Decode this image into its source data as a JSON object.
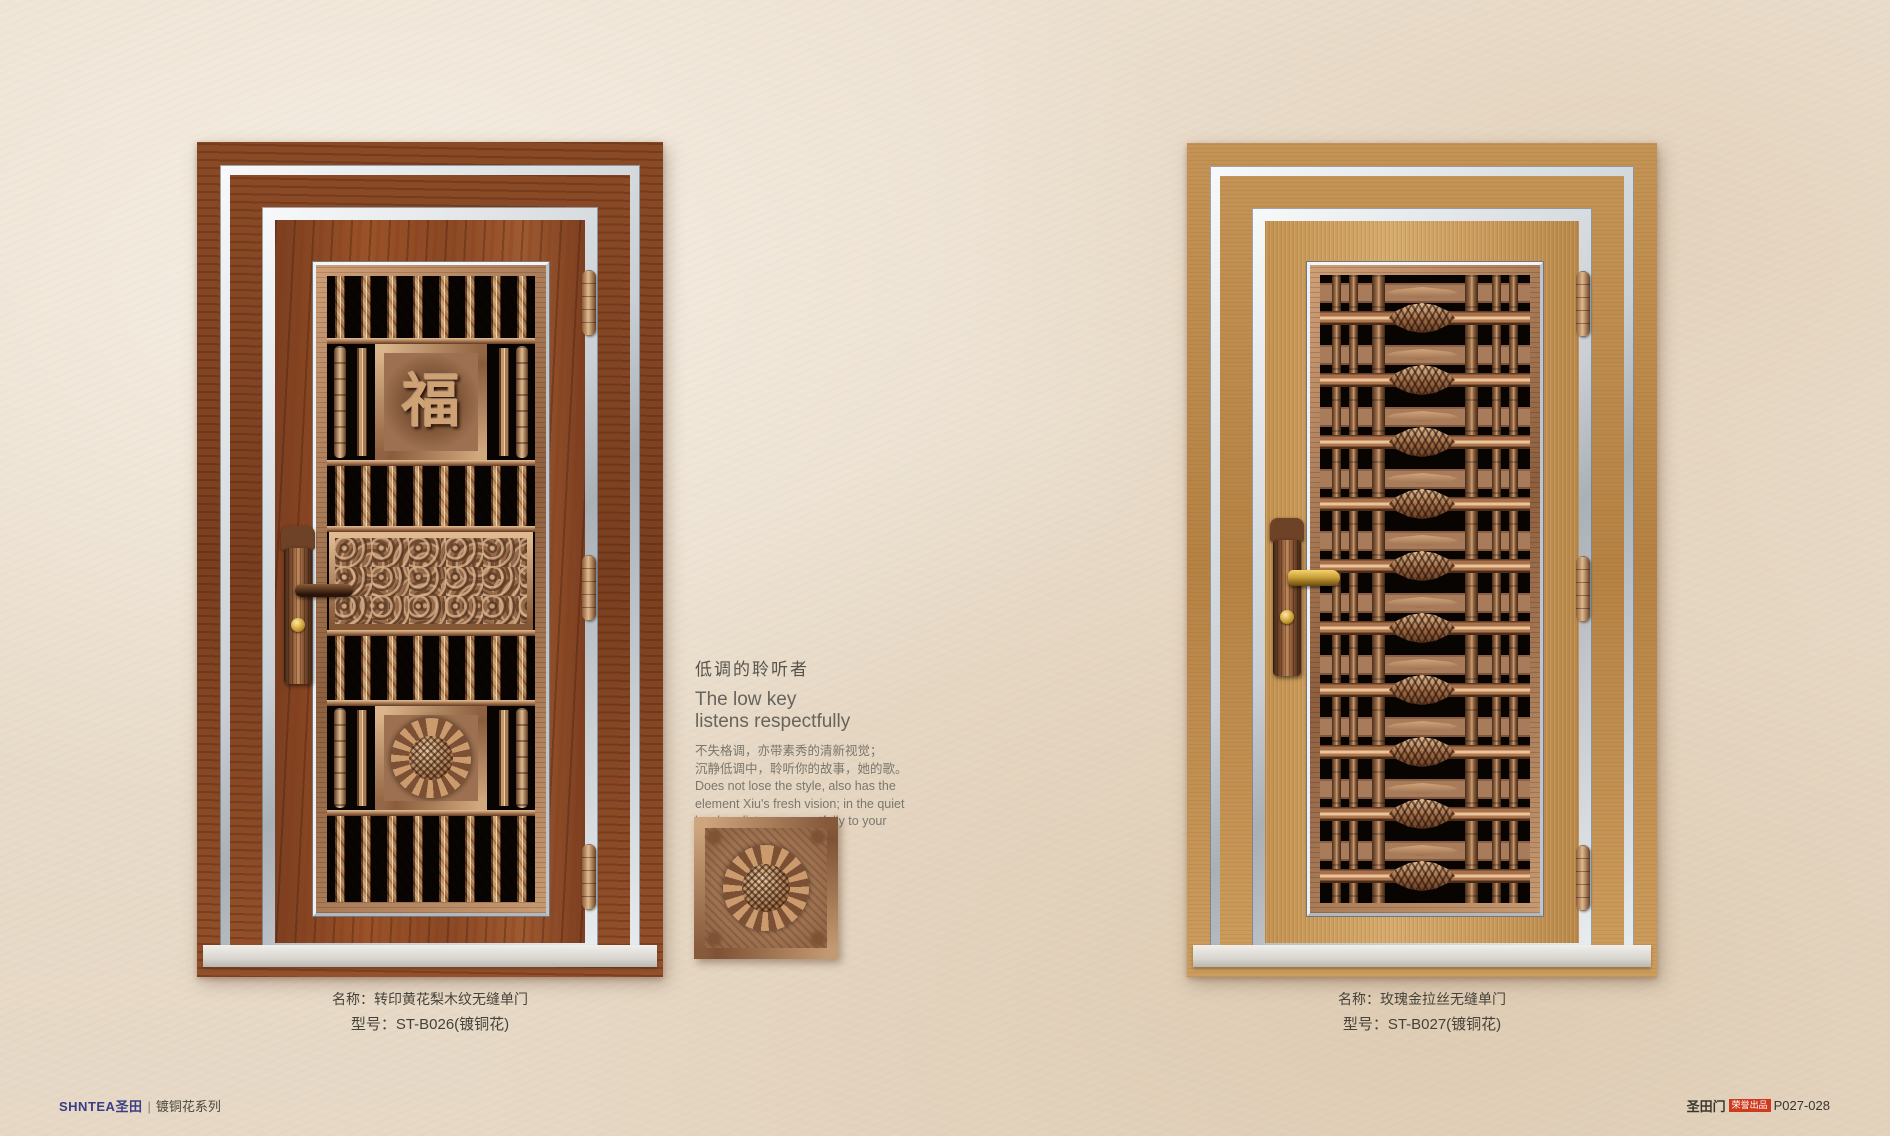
{
  "page": {
    "wall_color": "#ebdfce"
  },
  "colors": {
    "wood_red": "#8a4a26",
    "gold": "#c89a5e",
    "copper": "#b0805a",
    "silver_trim": "#d7dde1",
    "badge_red": "#cf3a1e",
    "logo_navy": "#3a3f85",
    "text_gray": "#76726a"
  },
  "left_door": {
    "caption_name": "名称：转印黄花梨木纹无缝单门",
    "caption_model": "型号：ST-B026(镀铜花)",
    "medallion_character": "福"
  },
  "right_door": {
    "caption_name": "名称：玫瑰金拉丝无缝单门",
    "caption_model": "型号：ST-B027(镀铜花)"
  },
  "center_text": {
    "title_zh": "低调的聆听者",
    "title_en_line1": "The low key",
    "title_en_line2": "listens respectfully",
    "body_zh_line1": "不失格调，亦带素秀的清新视觉；",
    "body_zh_line2": "沉静低调中，聆听你的故事，她的歌。",
    "body_en_line1": "Does not lose the style, also has the",
    "body_en_line2": "element Xiu's fresh vision; in the quiet",
    "body_en_line3": "low key, listens respectfully to your",
    "body_en_line4": "story, her song."
  },
  "footer": {
    "left_logo": "SHNTEA圣田",
    "left_divider": "|",
    "left_series": "镀铜花系列",
    "right_brand": "圣田门",
    "right_badge": "荣誉出品",
    "right_page": "P027-028"
  }
}
